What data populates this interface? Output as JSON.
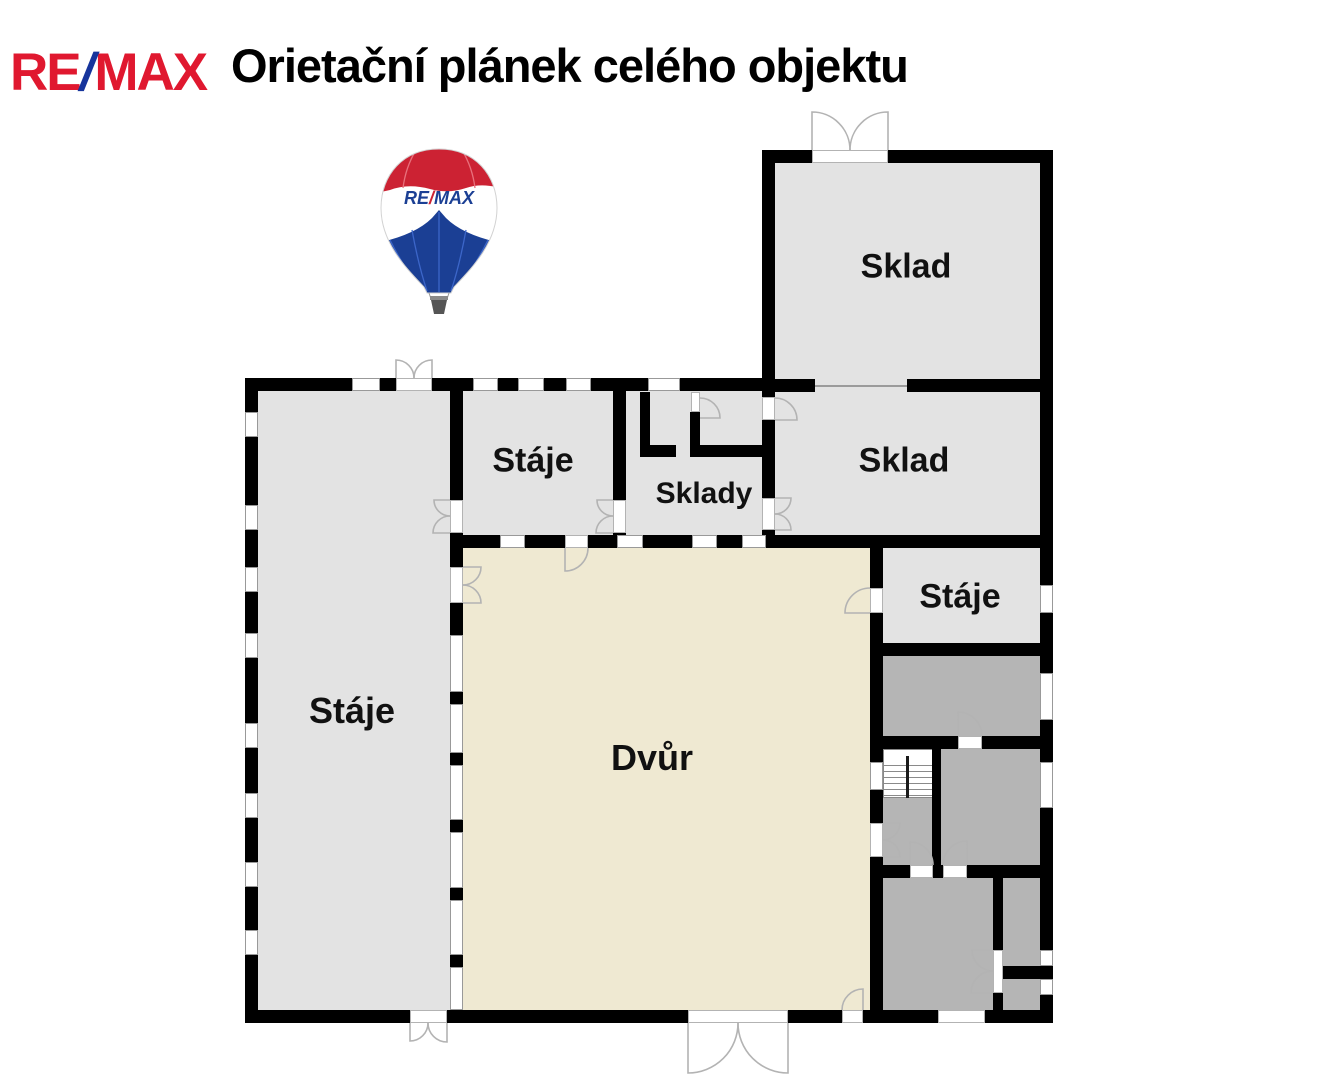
{
  "header": {
    "logo_re": "RE",
    "logo_slash": "/",
    "logo_max": "MAX",
    "title": "Orietační plánek celého objektu"
  },
  "balloon": {
    "re": "RE",
    "slash": "/",
    "max": "MAX"
  },
  "rooms": {
    "sklad_top": "Sklad",
    "sklad_right": "Sklad",
    "staje_middle": "Stáje",
    "sklady": "Sklady",
    "staje_left": "Stáje",
    "staje_right": "Stáje",
    "dvur": "Dvůr"
  },
  "colors": {
    "wall": "#000000",
    "room_light": "#e3e3e3",
    "room_dark": "#b5b5b5",
    "courtyard": "#efe9d2",
    "outline": "#9b9b9b",
    "window_frame": "#999999",
    "door_arc": "#b3b3b3",
    "label_text": "#111111",
    "logo_red": "#e0182f",
    "logo_blue": "#16349c",
    "balloon_red": "#cc2233",
    "balloon_blue": "#1b3f94",
    "basket_gray": "#555555"
  }
}
